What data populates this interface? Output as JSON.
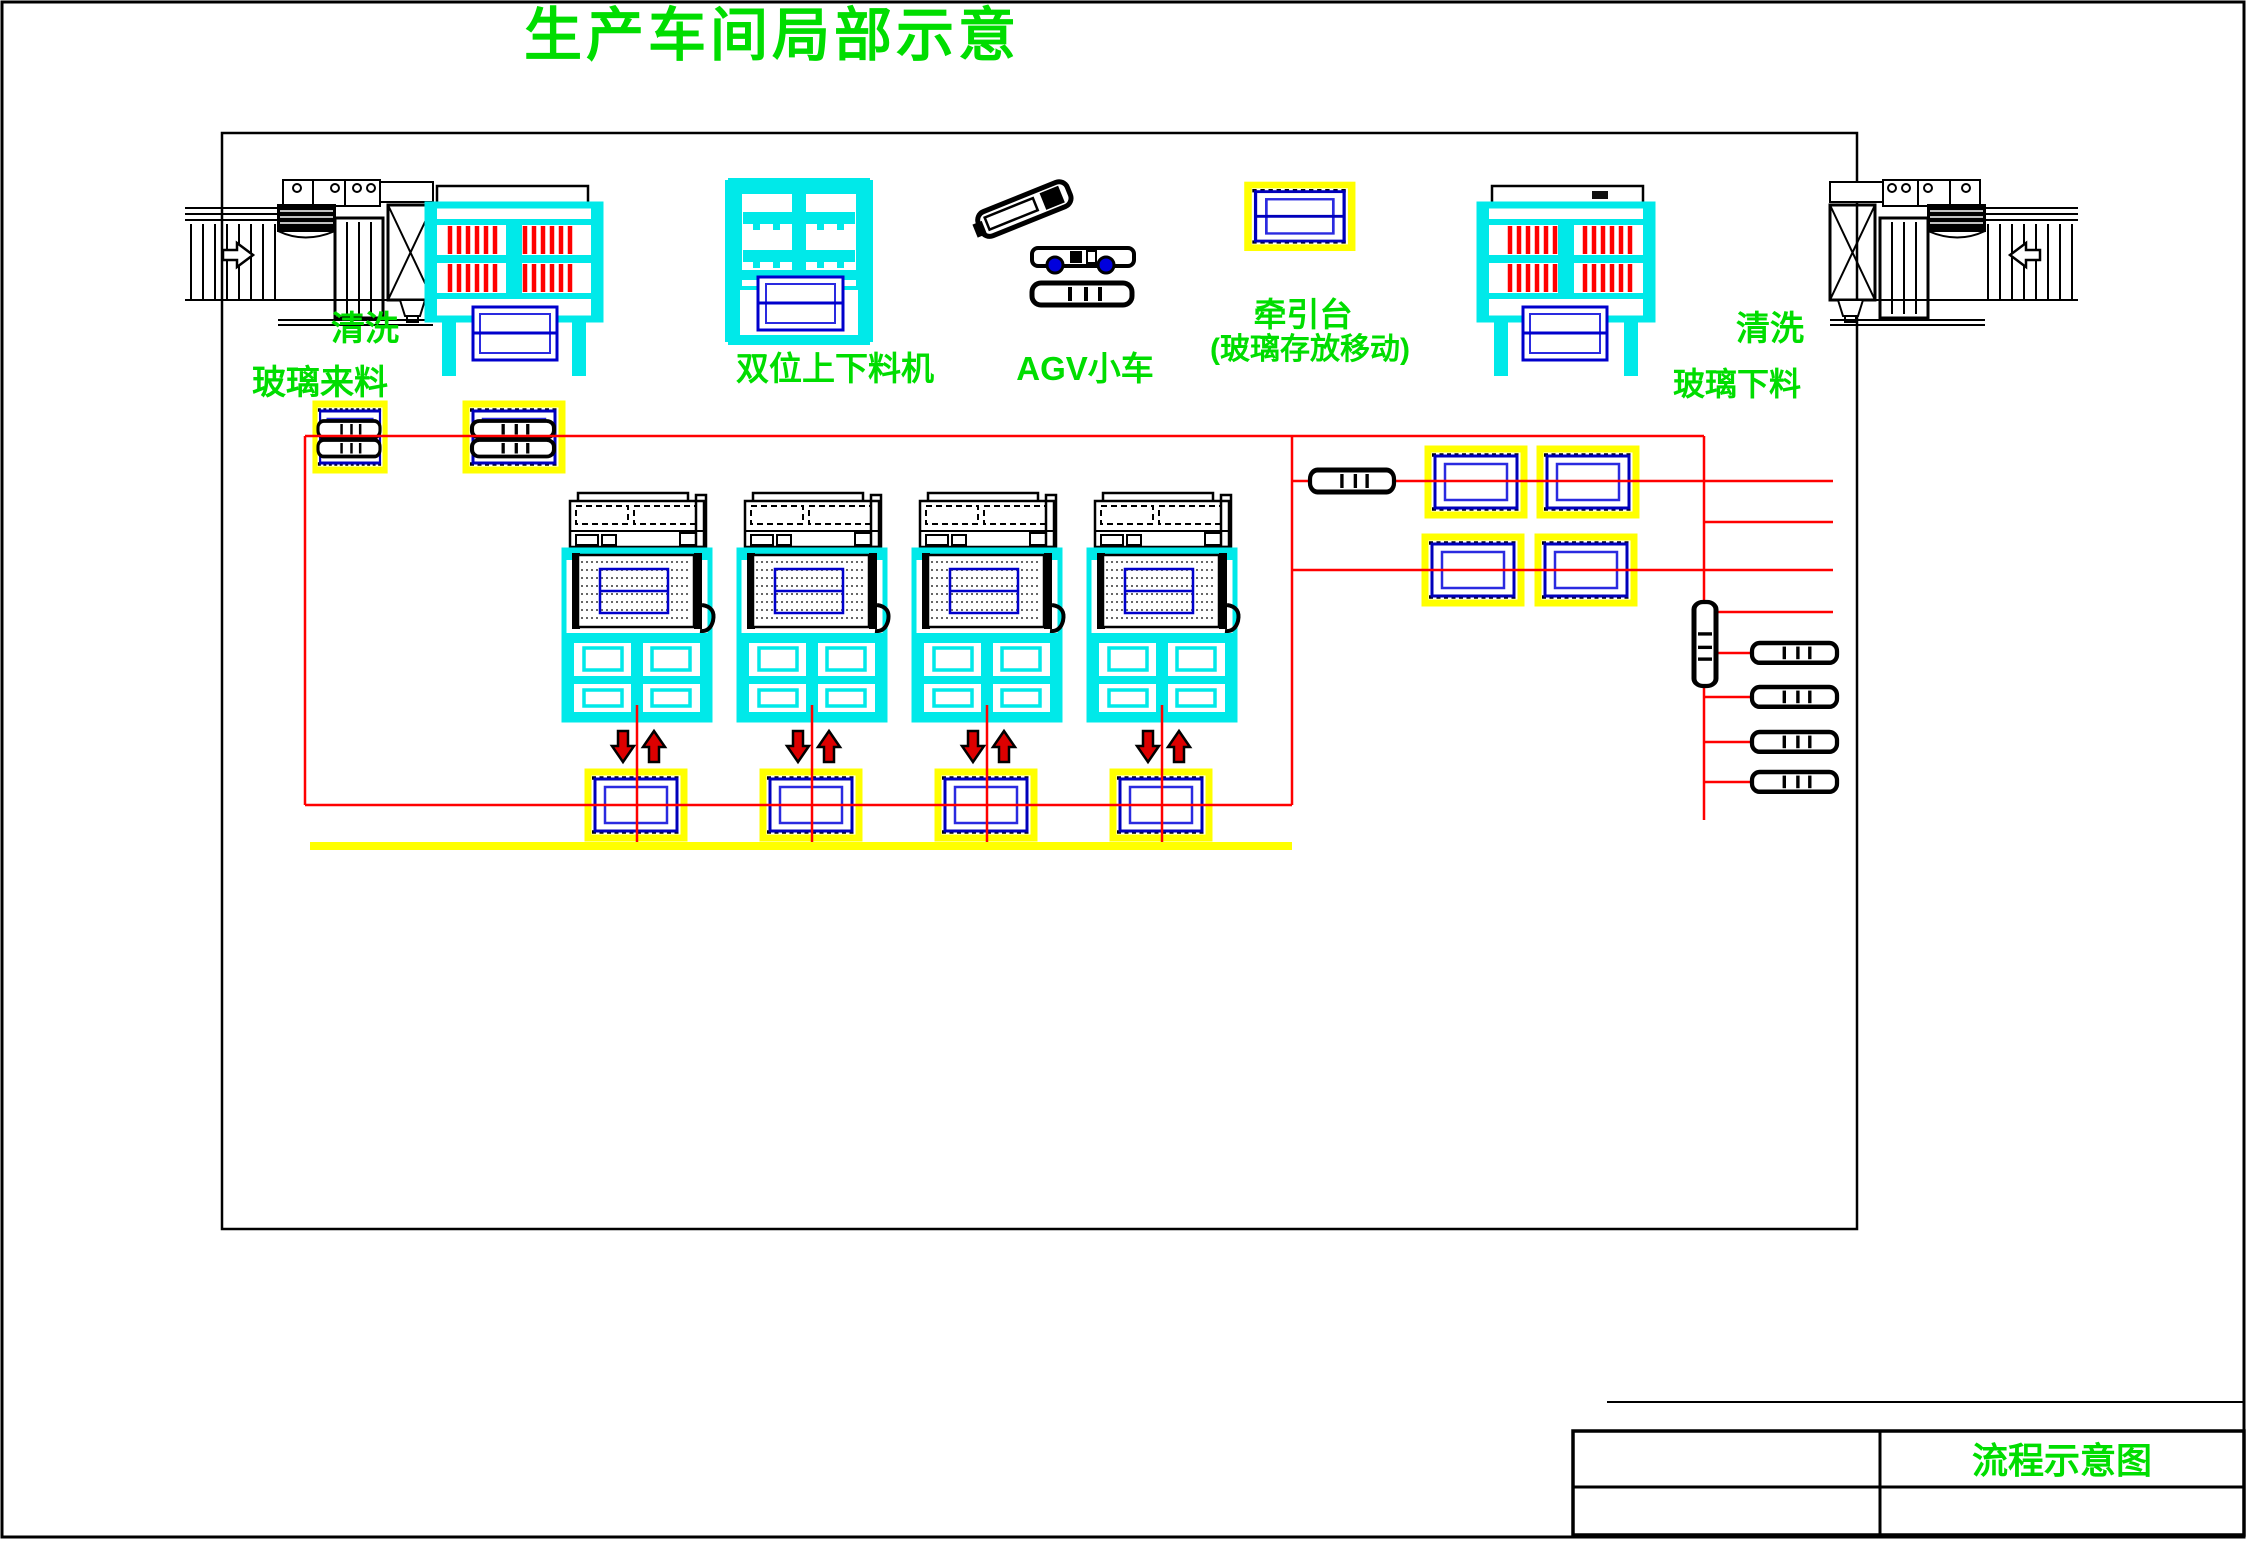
{
  "title": "生产车间局部示意",
  "labels": {
    "wash_left": "清洗",
    "glass_incoming": "玻璃来料",
    "dual_loader": "双位上下料机",
    "agv_cart": "AGV小车",
    "traction_name": "牵引台",
    "traction_note": "(玻璃存放移动)",
    "wash_right": "清洗",
    "glass_outgoing": "玻璃下料"
  },
  "title_block": {
    "drawing_title": "流程示意图"
  },
  "colors": {
    "label_green": "#00dd00",
    "machine_cyan": "#00ffff",
    "flow_red": "#ff0000",
    "glass_blue": "#0000cc",
    "platform_yellow": "#ffff00",
    "arrow_red": "#dd0000",
    "line_black": "#000000"
  }
}
